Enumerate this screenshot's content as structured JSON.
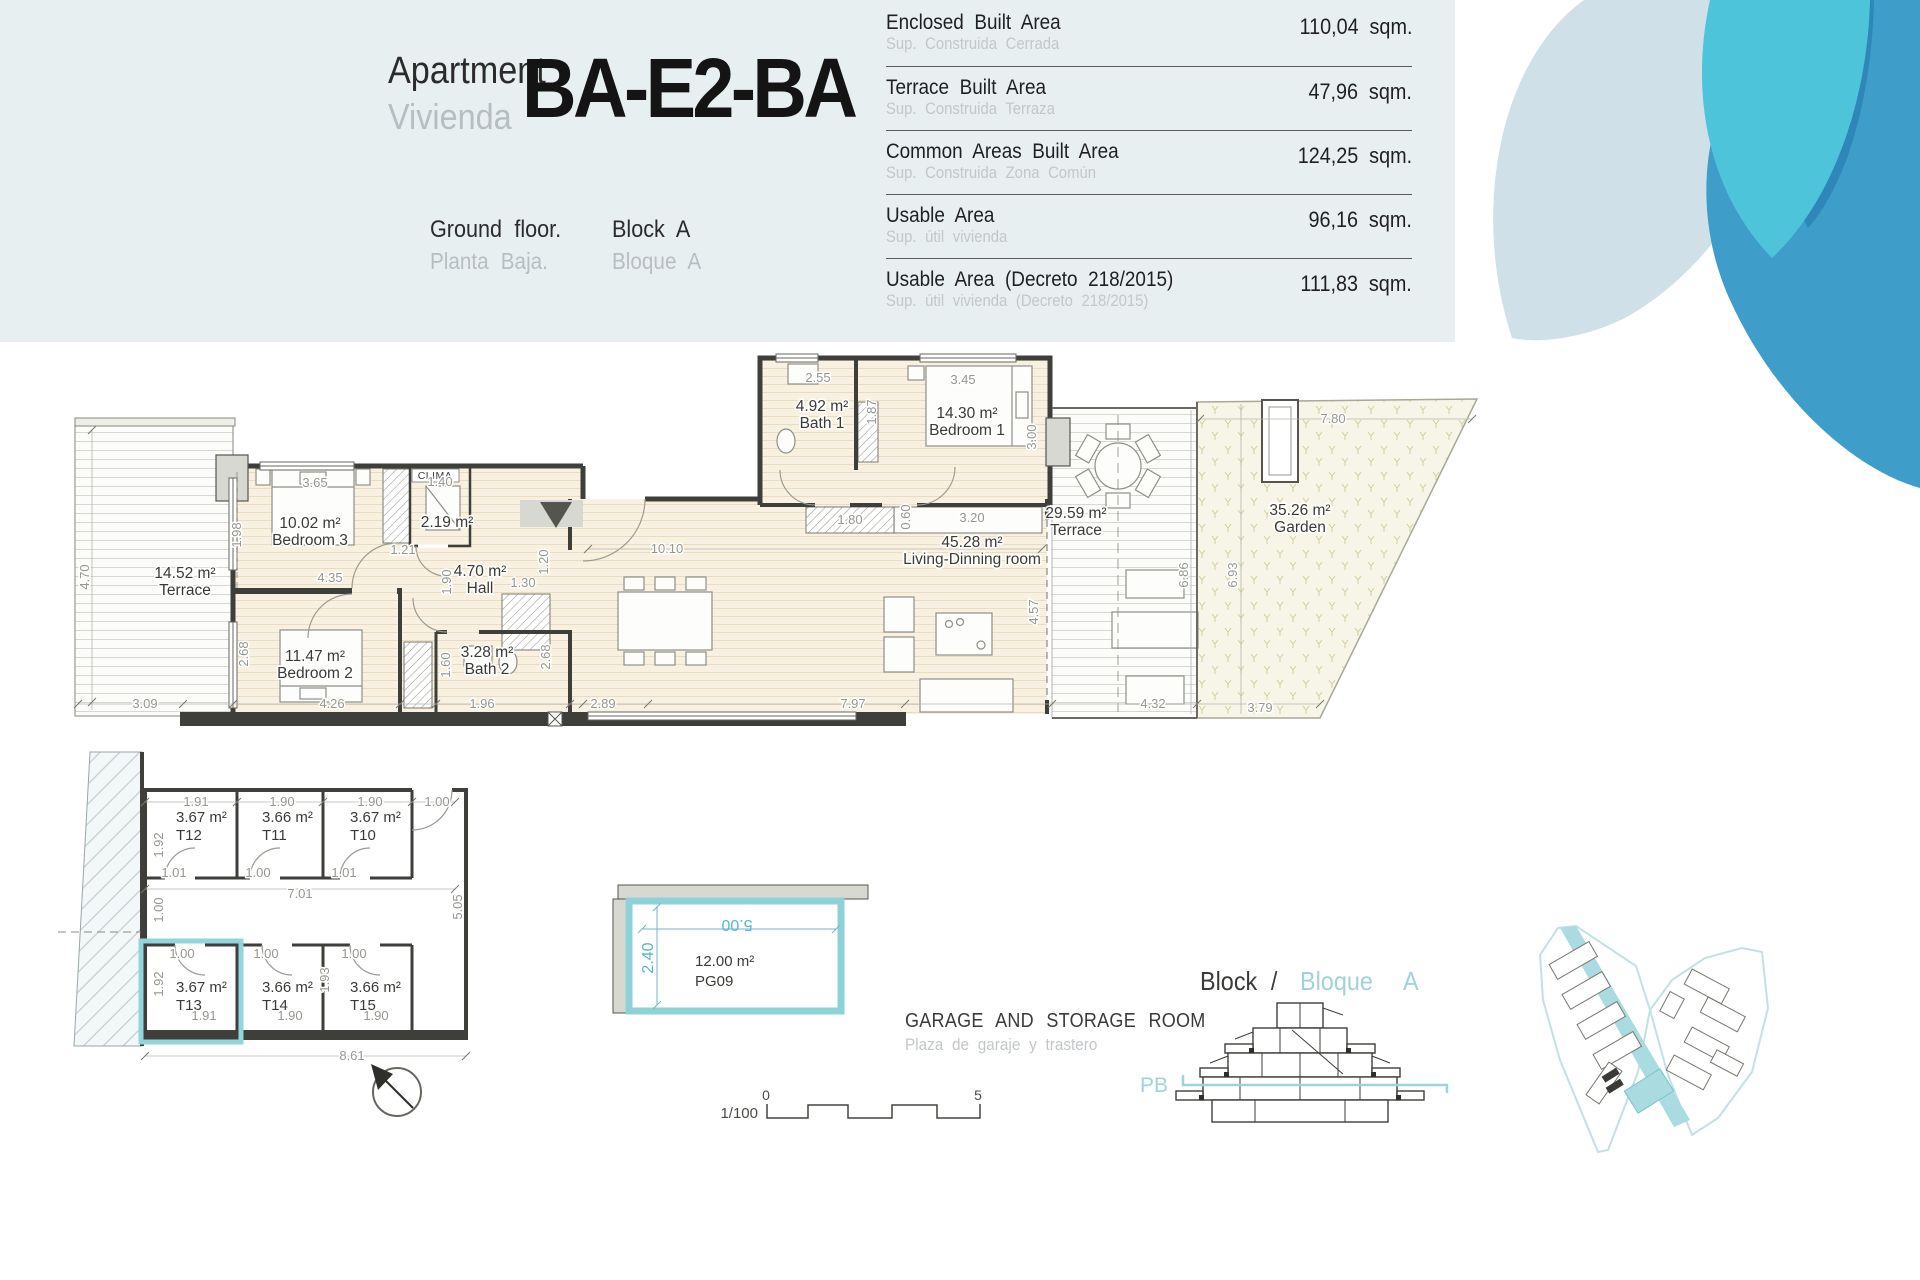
{
  "header": {
    "apartment_label_en": "Apartment",
    "apartment_label_es": "Vivienda",
    "apartment_code": "BA-E2-BA",
    "floor_en": "Ground floor.",
    "floor_es": "Planta Baja.",
    "block_en": "Block A",
    "block_es": "Bloque A"
  },
  "area_table": {
    "rows": [
      {
        "label": "Enclosed Built Area",
        "sublabel": "Sup. Construida Cerrada",
        "value": "110,04 sqm."
      },
      {
        "label": "Terrace Built Area",
        "sublabel": "Sup. Construida Terraza",
        "value": "47,96 sqm."
      },
      {
        "label": "Common Areas Built Area",
        "sublabel": "Sup. Construida Zona Común",
        "value": "124,25 sqm."
      },
      {
        "label": "Usable Area",
        "sublabel": "Sup. útil vivienda",
        "value": "96,16 sqm."
      },
      {
        "label": "Usable Area (Decreto 218/2015)",
        "sublabel": "Sup. útil vivienda (Decreto 218/2015)",
        "value": "111,83 sqm."
      }
    ]
  },
  "floor_plan": {
    "clima_label": "CLIMA",
    "rooms": [
      {
        "area": "14.52 m²",
        "name": "Terrace",
        "x": 185,
        "y": 578
      },
      {
        "area": "10.02 m²",
        "name": "Bedroom 3",
        "x": 310,
        "y": 528
      },
      {
        "area": "2.19 m²",
        "name": "",
        "x": 447,
        "y": 527
      },
      {
        "area": "4.70 m²",
        "name": "Hall",
        "x": 480,
        "y": 576
      },
      {
        "area": "11.47 m²",
        "name": "Bedroom 2",
        "x": 315,
        "y": 661
      },
      {
        "area": "3.28 m²",
        "name": "Bath 2",
        "x": 487,
        "y": 657
      },
      {
        "area": "4.92 m²",
        "name": "Bath 1",
        "x": 822,
        "y": 411
      },
      {
        "area": "14.30 m²",
        "name": "Bedroom 1",
        "x": 967,
        "y": 418
      },
      {
        "area": "45.28 m²",
        "name": "Living-Dinning room",
        "x": 972,
        "y": 547
      },
      {
        "area": "29.59 m²",
        "name": "Terrace",
        "x": 1076,
        "y": 518
      },
      {
        "area": "35.26 m²",
        "name": "Garden",
        "x": 1300,
        "y": 515
      }
    ],
    "dim_labels": [
      {
        "v": "3.65",
        "x": 315,
        "y": 487
      },
      {
        "v": "1.40",
        "x": 440,
        "y": 486
      },
      {
        "v": "2.55",
        "x": 818,
        "y": 382
      },
      {
        "v": "1.87",
        "x": 876,
        "y": 412,
        "rot": -90
      },
      {
        "v": "3.45",
        "x": 963,
        "y": 384
      },
      {
        "v": "3.00",
        "x": 1036,
        "y": 437,
        "rot": -90
      },
      {
        "v": "7.80",
        "x": 1333,
        "y": 423
      },
      {
        "v": "1.98",
        "x": 241,
        "y": 535,
        "rot": -90
      },
      {
        "v": "4.35",
        "x": 330,
        "y": 582
      },
      {
        "v": "1.21",
        "x": 403,
        "y": 554
      },
      {
        "v": "1.90",
        "x": 451,
        "y": 582,
        "rot": -90
      },
      {
        "v": "1.30",
        "x": 523,
        "y": 587
      },
      {
        "v": "1.20",
        "x": 548,
        "y": 562,
        "rot": -90
      },
      {
        "v": "10.10",
        "x": 667,
        "y": 553
      },
      {
        "v": "1.80",
        "x": 850,
        "y": 524
      },
      {
        "v": "0.60",
        "x": 910,
        "y": 517,
        "rot": -90
      },
      {
        "v": "3.20",
        "x": 972,
        "y": 522
      },
      {
        "v": "2.68",
        "x": 248,
        "y": 654,
        "rot": -90
      },
      {
        "v": "4.26",
        "x": 332,
        "y": 708
      },
      {
        "v": "1.60",
        "x": 450,
        "y": 665,
        "rot": -90
      },
      {
        "v": "1.96",
        "x": 482,
        "y": 708
      },
      {
        "v": "2.68",
        "x": 550,
        "y": 657,
        "rot": -90
      },
      {
        "v": "3.09",
        "x": 145,
        "y": 708
      },
      {
        "v": "4.70",
        "x": 89,
        "y": 577,
        "rot": -90
      },
      {
        "v": "2.89",
        "x": 603,
        "y": 708
      },
      {
        "v": "7.97",
        "x": 853,
        "y": 708
      },
      {
        "v": "4.57",
        "x": 1038,
        "y": 612,
        "rot": -90
      },
      {
        "v": "6.86",
        "x": 1188,
        "y": 575,
        "rot": -90
      },
      {
        "v": "6.93",
        "x": 1237,
        "y": 575,
        "rot": -90
      },
      {
        "v": "4.32",
        "x": 1153,
        "y": 708
      },
      {
        "v": "3.79",
        "x": 1260,
        "y": 712
      }
    ]
  },
  "storage": {
    "rooms": [
      {
        "area": "3.67 m²",
        "code": "T12",
        "x": 176,
        "y": 822
      },
      {
        "area": "3.66 m²",
        "code": "T11",
        "x": 262,
        "y": 822
      },
      {
        "area": "3.67 m²",
        "code": "T10",
        "x": 350,
        "y": 822
      },
      {
        "area": "3.67 m²",
        "code": "T13",
        "x": 176,
        "y": 992
      },
      {
        "area": "3.66 m²",
        "code": "T14",
        "x": 262,
        "y": 992
      },
      {
        "area": "3.66 m²",
        "code": "T15",
        "x": 350,
        "y": 992
      }
    ],
    "dim_labels": [
      {
        "v": "1.91",
        "x": 196,
        "y": 806
      },
      {
        "v": "1.90",
        "x": 282,
        "y": 806
      },
      {
        "v": "1.90",
        "x": 370,
        "y": 806
      },
      {
        "v": "1.00",
        "x": 437,
        "y": 806
      },
      {
        "v": "1.92",
        "x": 163,
        "y": 845,
        "rot": -90
      },
      {
        "v": "1.01",
        "x": 174,
        "y": 877
      },
      {
        "v": "1.00",
        "x": 258,
        "y": 877
      },
      {
        "v": "1.01",
        "x": 344,
        "y": 877
      },
      {
        "v": "7.01",
        "x": 300,
        "y": 898
      },
      {
        "v": "1.00",
        "x": 163,
        "y": 910,
        "rot": -90
      },
      {
        "v": "5.05",
        "x": 462,
        "y": 907,
        "rot": -90
      },
      {
        "v": "1.00",
        "x": 182,
        "y": 958
      },
      {
        "v": "1.00",
        "x": 266,
        "y": 958
      },
      {
        "v": "1.00",
        "x": 354,
        "y": 958
      },
      {
        "v": "1.92",
        "x": 163,
        "y": 984,
        "rot": -90
      },
      {
        "v": "1.93",
        "x": 329,
        "y": 980,
        "rot": -90
      },
      {
        "v": "1.91",
        "x": 204,
        "y": 1020
      },
      {
        "v": "1.90",
        "x": 290,
        "y": 1020
      },
      {
        "v": "1.90",
        "x": 376,
        "y": 1020
      },
      {
        "v": "8.61",
        "x": 352,
        "y": 1060
      }
    ]
  },
  "garage": {
    "width_label": "5.00",
    "depth_label": "2.40",
    "area_label": "12.00 m²",
    "code": "PG09"
  },
  "captions": {
    "garage_en": "GARAGE AND STORAGE ROOM",
    "garage_es": "Plaza de garaje y trastero",
    "scale_fraction": "1/100",
    "scale_zero": "0",
    "scale_five": "5"
  },
  "block_section": {
    "title_en": "Block /",
    "title_es": "Bloque",
    "block_letter": "A",
    "level_label": "PB"
  },
  "colors": {
    "accent_teal": "#8ed2d8",
    "teal_text": "#9fd3da",
    "pale_petal": "#cfe0e8",
    "cyan_petal": "#4ec4da",
    "blue_petal": "#3f9dc9",
    "header_band": "#e8eff1"
  }
}
